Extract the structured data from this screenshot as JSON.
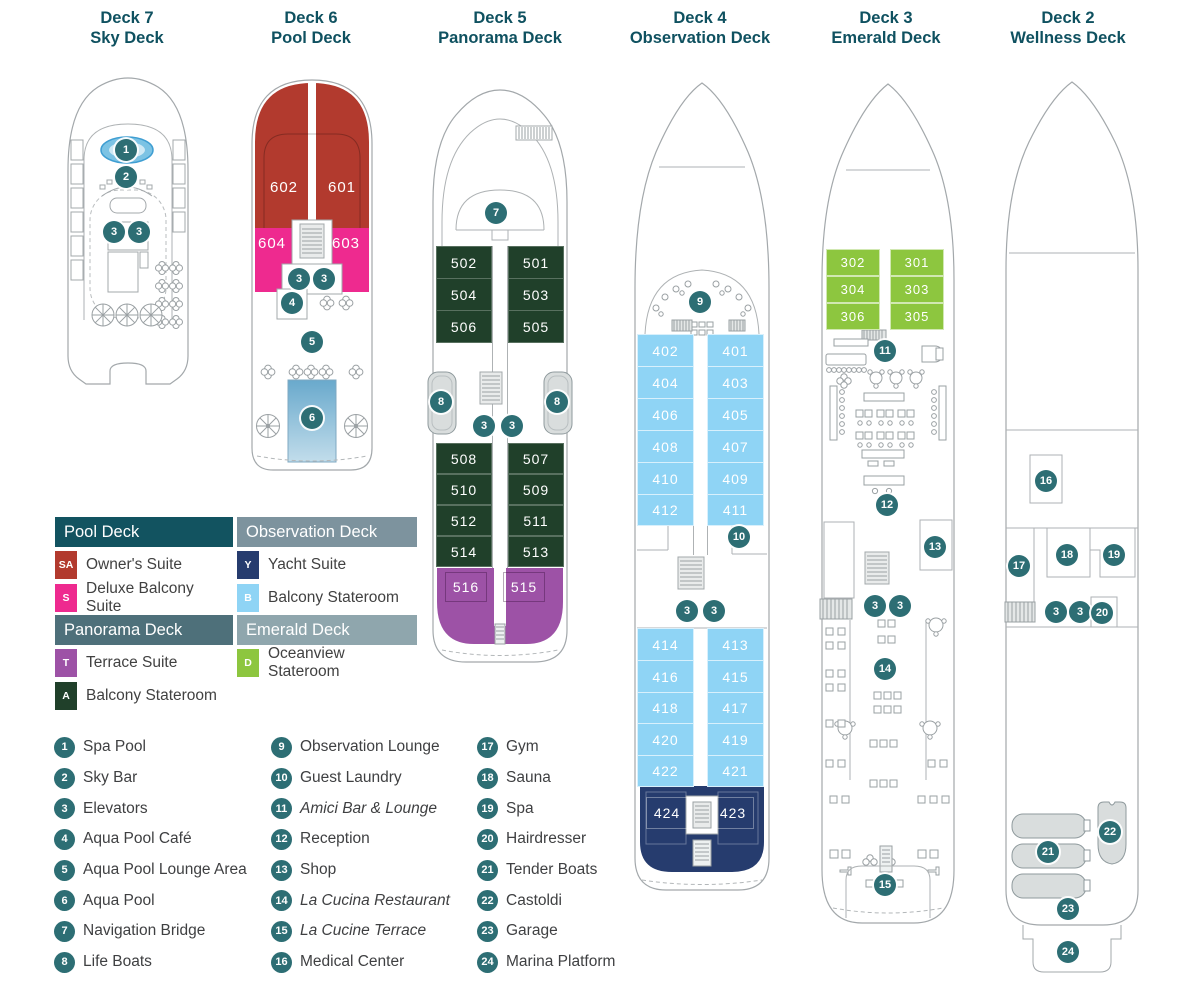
{
  "decks": [
    {
      "title": "Deck 7",
      "subtitle": "Sky Deck"
    },
    {
      "title": "Deck 6",
      "subtitle": "Pool Deck"
    },
    {
      "title": "Deck 5",
      "subtitle": "Panorama Deck"
    },
    {
      "title": "Deck 4",
      "subtitle": "Observation Deck"
    },
    {
      "title": "Deck 3",
      "subtitle": "Emerald Deck"
    },
    {
      "title": "Deck 2",
      "subtitle": "Wellness Deck"
    }
  ],
  "cabins": {
    "d6": [
      "602",
      "601",
      "604",
      "603"
    ],
    "d5u": [
      "502",
      "501",
      "504",
      "503",
      "506",
      "505"
    ],
    "d5l": [
      "508",
      "507",
      "510",
      "509",
      "512",
      "511",
      "514",
      "513"
    ],
    "d5t": [
      "516",
      "515"
    ],
    "d4u": [
      "402",
      "401",
      "404",
      "403",
      "406",
      "405",
      "408",
      "407",
      "410",
      "409",
      "412",
      "411"
    ],
    "d4l": [
      "414",
      "413",
      "416",
      "415",
      "418",
      "417",
      "420",
      "419",
      "422",
      "421"
    ],
    "d4y": [
      "424",
      "423"
    ],
    "d3": [
      "302",
      "301",
      "304",
      "303",
      "306",
      "305"
    ]
  },
  "m": {
    "d7": [
      "1",
      "2",
      "3",
      "3"
    ],
    "d6": [
      "3",
      "3",
      "4",
      "5",
      "6"
    ],
    "d5": [
      "7",
      "8",
      "8",
      "3",
      "3"
    ],
    "d4": [
      "9",
      "10",
      "3",
      "3"
    ],
    "d3": [
      "11",
      "12",
      "13",
      "3",
      "3",
      "14",
      "15"
    ],
    "d2": [
      "16",
      "17",
      "18",
      "19",
      "3",
      "3",
      "20",
      "21",
      "22",
      "23",
      "24"
    ]
  },
  "suite_legend": {
    "pool": {
      "header": "Pool Deck",
      "items": [
        {
          "code": "SA",
          "label": "Owner's Suite",
          "color": "#b23a2e"
        },
        {
          "code": "S",
          "label": "Deluxe Balcony Suite",
          "color": "#ee2a8f"
        }
      ]
    },
    "panorama": {
      "header": "Panorama Deck",
      "items": [
        {
          "code": "T",
          "label": "Terrace Suite",
          "color": "#9d52a6"
        },
        {
          "code": "A",
          "label": "Balcony Stateroom",
          "color": "#20402a"
        }
      ]
    },
    "observation": {
      "header": "Observation Deck",
      "items": [
        {
          "code": "Y",
          "label": "Yacht Suite",
          "color": "#263c6e"
        },
        {
          "code": "B",
          "label": "Balcony Stateroom",
          "color": "#8fd4f5"
        }
      ]
    },
    "emerald": {
      "header": "Emerald Deck",
      "items": [
        {
          "code": "D",
          "label": "Oceanview Stateroom",
          "color": "#8dc63f"
        }
      ]
    }
  },
  "locations": {
    "col1": [
      {
        "num": "1",
        "label": "Spa Pool"
      },
      {
        "num": "2",
        "label": "Sky Bar"
      },
      {
        "num": "3",
        "label": "Elevators"
      },
      {
        "num": "4",
        "label": "Aqua Pool Café"
      },
      {
        "num": "5",
        "label": "Aqua Pool Lounge Area"
      },
      {
        "num": "6",
        "label": "Aqua Pool"
      },
      {
        "num": "7",
        "label": "Navigation Bridge"
      },
      {
        "num": "8",
        "label": "Life Boats"
      }
    ],
    "col2": [
      {
        "num": "9",
        "label": "Observation Lounge"
      },
      {
        "num": "10",
        "label": "Guest Laundry"
      },
      {
        "num": "11",
        "label": "Amici Bar & Lounge"
      },
      {
        "num": "12",
        "label": "Reception"
      },
      {
        "num": "13",
        "label": "Shop"
      },
      {
        "num": "14",
        "label": "La Cucina Restaurant"
      },
      {
        "num": "15",
        "label": "La Cucine Terrace"
      },
      {
        "num": "16",
        "label": "Medical Center"
      }
    ],
    "col3": [
      {
        "num": "17",
        "label": "Gym"
      },
      {
        "num": "18",
        "label": "Sauna"
      },
      {
        "num": "19",
        "label": "Spa"
      },
      {
        "num": "20",
        "label": "Hairdresser"
      },
      {
        "num": "21",
        "label": "Tender Boats"
      },
      {
        "num": "22",
        "label": "Castoldi"
      },
      {
        "num": "23",
        "label": "Garage"
      },
      {
        "num": "24",
        "label": "Marina Platform"
      }
    ]
  },
  "colors": {
    "title_teal": "#0f5160",
    "marker": "#2d6e74",
    "owner_red": "#b23a2e",
    "deluxe_pink": "#ee2a8f",
    "yacht_navy": "#263c6e",
    "balcony_blue": "#8fd4f5",
    "balcony_green": "#20402a",
    "terrace_purple": "#9d52a6",
    "oceanview_lime": "#8dc63f",
    "header_pool": "#125360",
    "header_observation": "#7d939e",
    "header_panorama": "#4e707a",
    "header_emerald": "#8fa6ad"
  }
}
